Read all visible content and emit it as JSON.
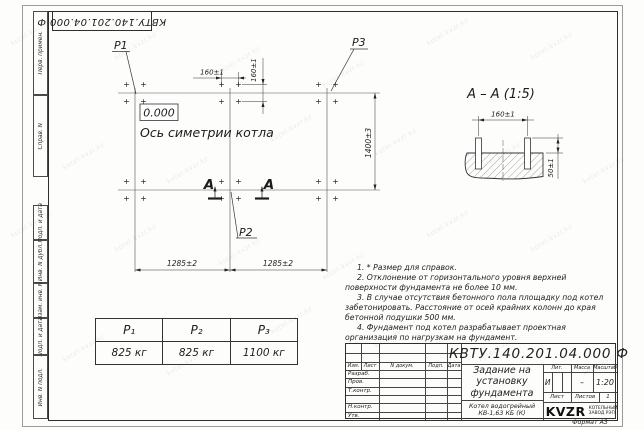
{
  "doc": {
    "number_full": "КВТУ.140.201.04.000 Ф"
  },
  "frame": {
    "left_labels": [
      "Перв. примен.",
      "Справ. N",
      "Подп. и дата",
      "Инв. N дубл.",
      "Взам. инв. N",
      "Подп. и дата",
      "Инв. N подл."
    ],
    "format_label": "Формат А3"
  },
  "watermark": {
    "text": "kotel-kvzr.kz"
  },
  "plan": {
    "p1": "P1",
    "p2": "P2",
    "p3": "P3",
    "elevation": "0.000",
    "axis_label": "Ось симетрии котла",
    "dim_bolt_horizontal": "160±1",
    "dim_bolt_vertical": "160±1",
    "dim_span_left": "1285±2",
    "dim_span_right": "1285±2",
    "dim_depth": "1400±3",
    "cut_letter": "А"
  },
  "section": {
    "title": "А – А (1:5)",
    "dim_spacing": "160±1",
    "dim_protrusion": "50±1"
  },
  "loads_table": {
    "headers": [
      "P₁",
      "P₂",
      "P₃"
    ],
    "values": [
      "825 кг",
      "825 кг",
      "1100 кг"
    ]
  },
  "notes": {
    "items": [
      "1. * Размер для справок.",
      "2. Отклонение от горизонтального уровня верхней поверхности фундамента не более 10 мм.",
      "3. В случае отсутствия бетонного пола площадку под котел забетонировать. Расстояние от осей крайних колонн до края бетонной подушки 500 мм.",
      "4. Фундамент под котел разрабатывает проектная организация по нагрузкам на фундамент."
    ]
  },
  "title_block": {
    "title_lines": [
      "Задание на",
      "установку",
      "фундамента"
    ],
    "product_lines": [
      "Котел водогрейный",
      "КВ-1,63 КБ (К)"
    ],
    "change_columns": [
      "Изм.",
      "Лист",
      "N докум.",
      "Подп.",
      "Дата"
    ],
    "sign_rows": [
      "Разраб.",
      "Пров.",
      "Т.контр.",
      "Н.контр.",
      "Утв."
    ],
    "lit_label": "Лит.",
    "lit_value": "И",
    "mass_label": "Масса",
    "mass_value": "–",
    "scale_label": "Масштаб",
    "scale_value": "1:20",
    "sheet_label": "Лист",
    "sheets_label": "Листов",
    "sheets_value": "1",
    "logo_text": "KVZR",
    "company_lines": [
      "КОТЕЛЬНЫЙ",
      "ЗАВОД РЭП"
    ]
  }
}
